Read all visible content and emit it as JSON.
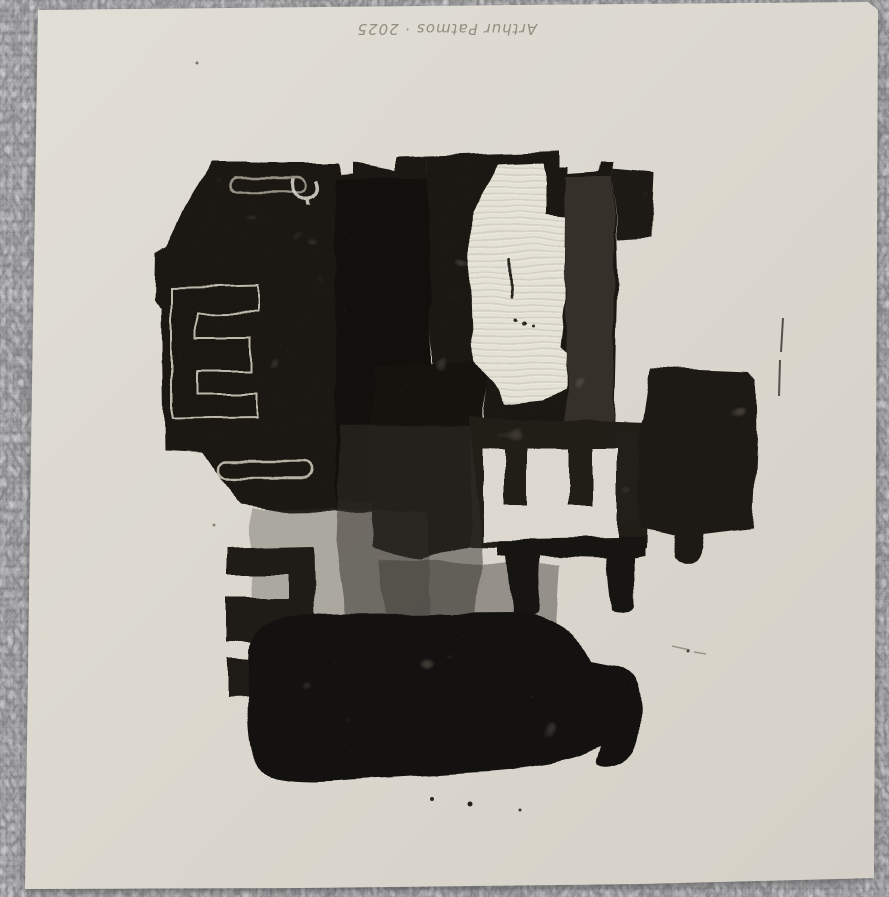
{
  "artwork": {
    "kind": "photograph of an abstract black-ink monotype print on cream paper, laid on gray textured fabric",
    "signature": {
      "text": "Arthur Patmos · 2025",
      "medium": "pencil",
      "orientation": "upside-down, top center of sheet"
    },
    "palette": {
      "fabric_gray": "#9b9b9d",
      "paper_cream": "#dcd8cf",
      "paper_light": "#e2dfd7",
      "ink_black": "#17140f",
      "ink_gray_wash": "#3b3731",
      "corrugation_line": "#d2cfc2",
      "pencil_gray": "#8b8679"
    },
    "elements": [
      "upper-left ink block with engraved letter E outline and two handle slots",
      "hook-shaped white mark",
      "central ink block with unprinted corrugated-cardboard area",
      "right ink block with small foot",
      "white unprinted letter E with prongs pointing up",
      "black table-like shape with two legs",
      "black letter E facing left at lower left",
      "large rounded bottom ink blob with right nose",
      "thin vertical scratch at right",
      "scattered ink specks"
    ]
  }
}
